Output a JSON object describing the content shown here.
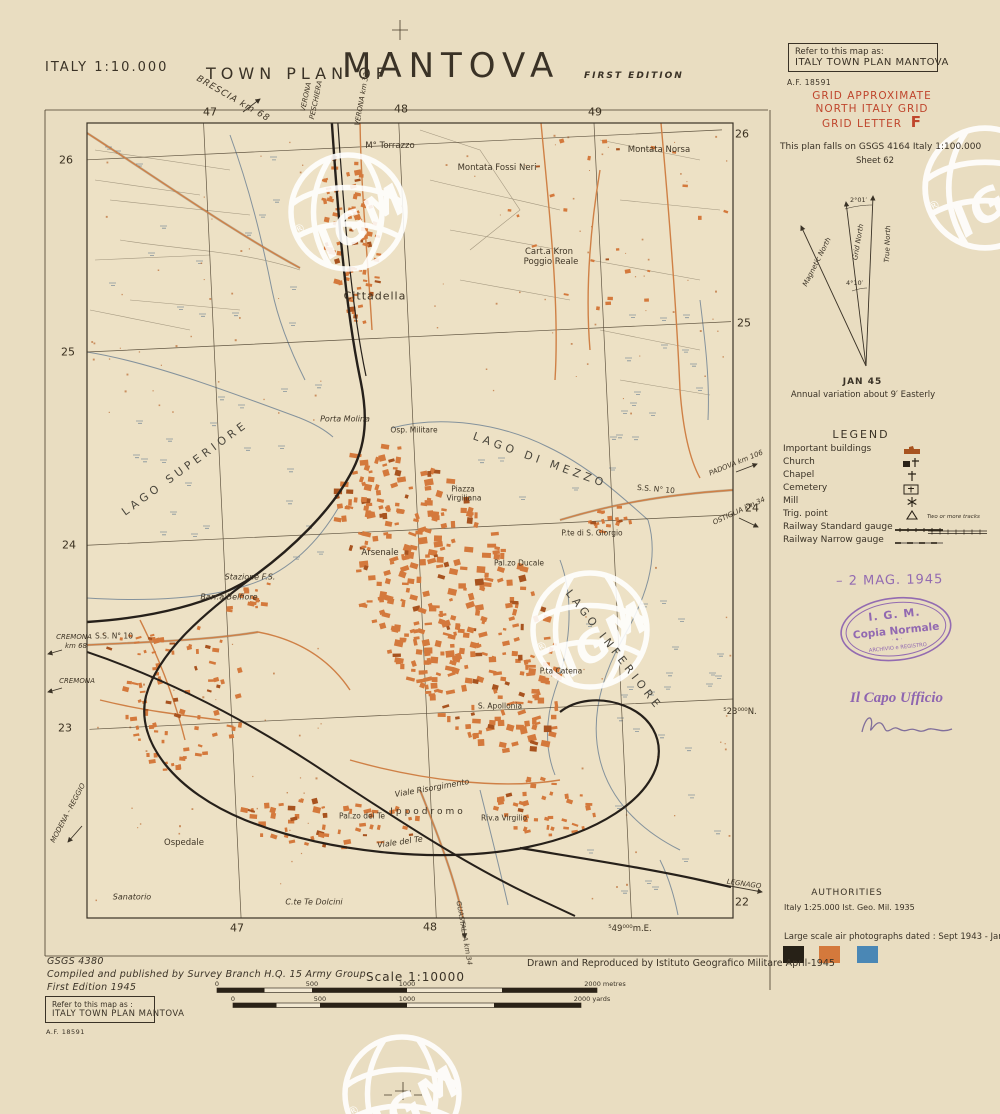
{
  "header": {
    "scale_note": "ITALY 1:10.000",
    "title_prefix": "TOWN PLAN OF",
    "title": "MANTOVA",
    "edition": "FIRST EDITION"
  },
  "refer_box_top": {
    "line1": "Refer to this map as:",
    "line2": "ITALY TOWN PLAN MANTOVA",
    "ref_no": "A.F. 18591"
  },
  "grid_note": {
    "line1": "GRID APPROXIMATE",
    "line2": "NORTH ITALY GRID",
    "line3": "GRID LETTER",
    "letter": "F",
    "color": "#bf452c"
  },
  "falls_note": {
    "line1": "This plan falls on GSGS 4164 Italy 1:100.000",
    "line2": "Sheet 62"
  },
  "north_diagram": {
    "true_north": "True North",
    "grid_north": "Grid North",
    "magnetic_north": "Magnetic North",
    "angle_top": "2°01′",
    "angle_bottom": "4°10′",
    "date": "JAN 45",
    "variation": "Annual variation about  9′ Easterly"
  },
  "legend": {
    "title": "LEGEND",
    "items": [
      {
        "label": "Important buildings"
      },
      {
        "label": "Church"
      },
      {
        "label": "Chapel"
      },
      {
        "label": "Cemetery"
      },
      {
        "label": "Mill"
      },
      {
        "label": "Trig. point"
      },
      {
        "label": "Railway Standard gauge"
      },
      {
        "label": "Railway Narrow gauge"
      }
    ],
    "two_tracks_note": "Two or more tracks"
  },
  "stamps": {
    "date_stamp": "– 2 MAG. 1945",
    "igm_line1": "I. G. M.",
    "igm_line2": "Copia Normale",
    "igm_line3": "ARCHIVIO e REGISTRO",
    "capo": "Il Capo Ufficio"
  },
  "authorities": {
    "title": "AUTHORITIES",
    "line1": "Italy 1:25.000   Ist. Geo. Mil. 1935",
    "photos": "Large scale air photographs dated : Sept 1943 - Jan 1944"
  },
  "swatches": [
    "#272117",
    "#d4793c",
    "#4a87b5"
  ],
  "imprint": {
    "series": "GSGS 4380",
    "compiled": "Compiled and published by Survey Branch H.Q. 15 Army Group",
    "edition": "First Edition 1945",
    "drawn": "Drawn and Reproduced by Istituto Geografico Militare  April-1945"
  },
  "refer_box_bottom": {
    "line1": "Refer to this map as :",
    "line2": "ITALY TOWN PLAN MANTOVA",
    "ref_no": "A.F. 18591"
  },
  "scalebar": {
    "label": "Scale  1:10000",
    "metres": [
      "0",
      "500",
      "1000",
      "2000 metres"
    ],
    "yards": [
      "0",
      "500",
      "1000",
      "2000 yards"
    ]
  },
  "watermark": {
    "text": "IGM",
    "reg": "®"
  },
  "map": {
    "labels": [
      {
        "t": "47",
        "x": 210,
        "y": 112,
        "c": "g"
      },
      {
        "t": "48",
        "x": 401,
        "y": 109,
        "c": "g"
      },
      {
        "t": "49",
        "x": 595,
        "y": 112,
        "c": "g"
      },
      {
        "t": "26",
        "x": 66,
        "y": 160,
        "c": "g"
      },
      {
        "t": "25",
        "x": 68,
        "y": 352,
        "c": "g"
      },
      {
        "t": "24",
        "x": 69,
        "y": 545,
        "c": "g"
      },
      {
        "t": "23",
        "x": 65,
        "y": 728,
        "c": "g"
      },
      {
        "t": "26",
        "x": 742,
        "y": 134,
        "c": "g"
      },
      {
        "t": "25",
        "x": 744,
        "y": 323,
        "c": "g"
      },
      {
        "t": "24",
        "x": 752,
        "y": 508,
        "c": "g"
      },
      {
        "t": "⁵23⁰⁰⁰N.",
        "x": 740,
        "y": 712,
        "c": "g2"
      },
      {
        "t": "22",
        "x": 742,
        "y": 902,
        "c": "g"
      },
      {
        "t": "47",
        "x": 237,
        "y": 928,
        "c": "g"
      },
      {
        "t": "48",
        "x": 430,
        "y": 927,
        "c": "g"
      },
      {
        "t": "⁵49⁰⁰⁰m.E.",
        "x": 630,
        "y": 929,
        "c": "g2"
      },
      {
        "t": "LAGO SUPERIORE",
        "x": 185,
        "y": 468,
        "r": -36,
        "c": "lk"
      },
      {
        "t": "LAGO DI MEZZO",
        "x": 540,
        "y": 460,
        "r": 20,
        "c": "lk"
      },
      {
        "t": "LAGO INFERIORE",
        "x": 614,
        "y": 650,
        "r": 52,
        "c": "lk"
      },
      {
        "t": "M° Torrazzo",
        "x": 390,
        "y": 146,
        "c": "ps"
      },
      {
        "t": "Montata Fossi Neri",
        "x": 497,
        "y": 168,
        "c": "ps"
      },
      {
        "t": "Montata Norsa",
        "x": 659,
        "y": 150,
        "c": "ps"
      },
      {
        "t": "Cart.a Kron",
        "x": 549,
        "y": 252,
        "c": "ps"
      },
      {
        "t": "Poggio Reale",
        "x": 551,
        "y": 262,
        "c": "ps"
      },
      {
        "t": "Cittadella",
        "x": 375,
        "y": 296,
        "c": "p2"
      },
      {
        "t": "Porta Molina",
        "x": 345,
        "y": 419,
        "c": "i"
      },
      {
        "t": "Osp. Militare",
        "x": 414,
        "y": 430,
        "c": "t"
      },
      {
        "t": "Piazza",
        "x": 463,
        "y": 489,
        "c": "t"
      },
      {
        "t": "Virgiliana",
        "x": 464,
        "y": 498,
        "c": "t"
      },
      {
        "t": "Arsenale",
        "x": 380,
        "y": 553,
        "c": "ps"
      },
      {
        "t": "Pal.zo Ducale",
        "x": 519,
        "y": 563,
        "c": "t"
      },
      {
        "t": "P.te di S. Giorgio",
        "x": 592,
        "y": 533,
        "c": "t"
      },
      {
        "t": "Stazione F.S.",
        "x": 250,
        "y": 577,
        "c": "i"
      },
      {
        "t": "Barr.a Belfiore",
        "x": 229,
        "y": 597,
        "c": "i"
      },
      {
        "t": "P.ta Catena",
        "x": 561,
        "y": 671,
        "c": "t"
      },
      {
        "t": "S. Apollonia",
        "x": 500,
        "y": 706,
        "c": "t"
      },
      {
        "t": "Pal.zo del Te",
        "x": 362,
        "y": 816,
        "c": "t"
      },
      {
        "t": "Ippodromo",
        "x": 428,
        "y": 812,
        "c": "ps2"
      },
      {
        "t": "Viale del Te",
        "x": 400,
        "y": 842,
        "r": -8,
        "c": "i"
      },
      {
        "t": "Viale Risorgimento",
        "x": 432,
        "y": 788,
        "r": -10,
        "c": "i"
      },
      {
        "t": "Riv.a Virgilio",
        "x": 504,
        "y": 818,
        "c": "t"
      },
      {
        "t": "Ospedale",
        "x": 184,
        "y": 843,
        "c": "ps"
      },
      {
        "t": "Sanatorio",
        "x": 132,
        "y": 897,
        "c": "i"
      },
      {
        "t": "C.te Te Dolcini",
        "x": 314,
        "y": 902,
        "c": "i"
      },
      {
        "t": "BRESCIA km 68",
        "x": 233,
        "y": 99,
        "r": 30,
        "c": "i2"
      },
      {
        "t": "VERONA",
        "x": 306,
        "y": 97,
        "r": -78,
        "c": "t2"
      },
      {
        "t": "PESCHIERA",
        "x": 316,
        "y": 100,
        "r": -78,
        "c": "t2"
      },
      {
        "t": "VERONA km 33",
        "x": 362,
        "y": 99,
        "r": -80,
        "c": "t2"
      },
      {
        "t": "CREMONA",
        "x": 74,
        "y": 637,
        "c": "t2"
      },
      {
        "t": "km 68",
        "x": 76,
        "y": 646,
        "c": "t2"
      },
      {
        "t": "S.S. N° 10",
        "x": 114,
        "y": 636,
        "c": "t"
      },
      {
        "t": "CREMONA",
        "x": 77,
        "y": 681,
        "c": "t2"
      },
      {
        "t": "MODENA - REGGIO",
        "x": 68,
        "y": 813,
        "r": -62,
        "c": "t2"
      },
      {
        "t": "PADOVA km 106",
        "x": 736,
        "y": 463,
        "r": -22,
        "c": "t2"
      },
      {
        "t": "OSTIGLIA km 34",
        "x": 739,
        "y": 511,
        "r": -25,
        "c": "t2"
      },
      {
        "t": "S.S. N° 10",
        "x": 656,
        "y": 489,
        "r": 5,
        "c": "t"
      },
      {
        "t": "LEGNAGO",
        "x": 744,
        "y": 884,
        "r": 8,
        "c": "t2"
      },
      {
        "t": "GUASTALLA km 34",
        "x": 464,
        "y": 933,
        "r": 80,
        "c": "t2"
      }
    ]
  }
}
